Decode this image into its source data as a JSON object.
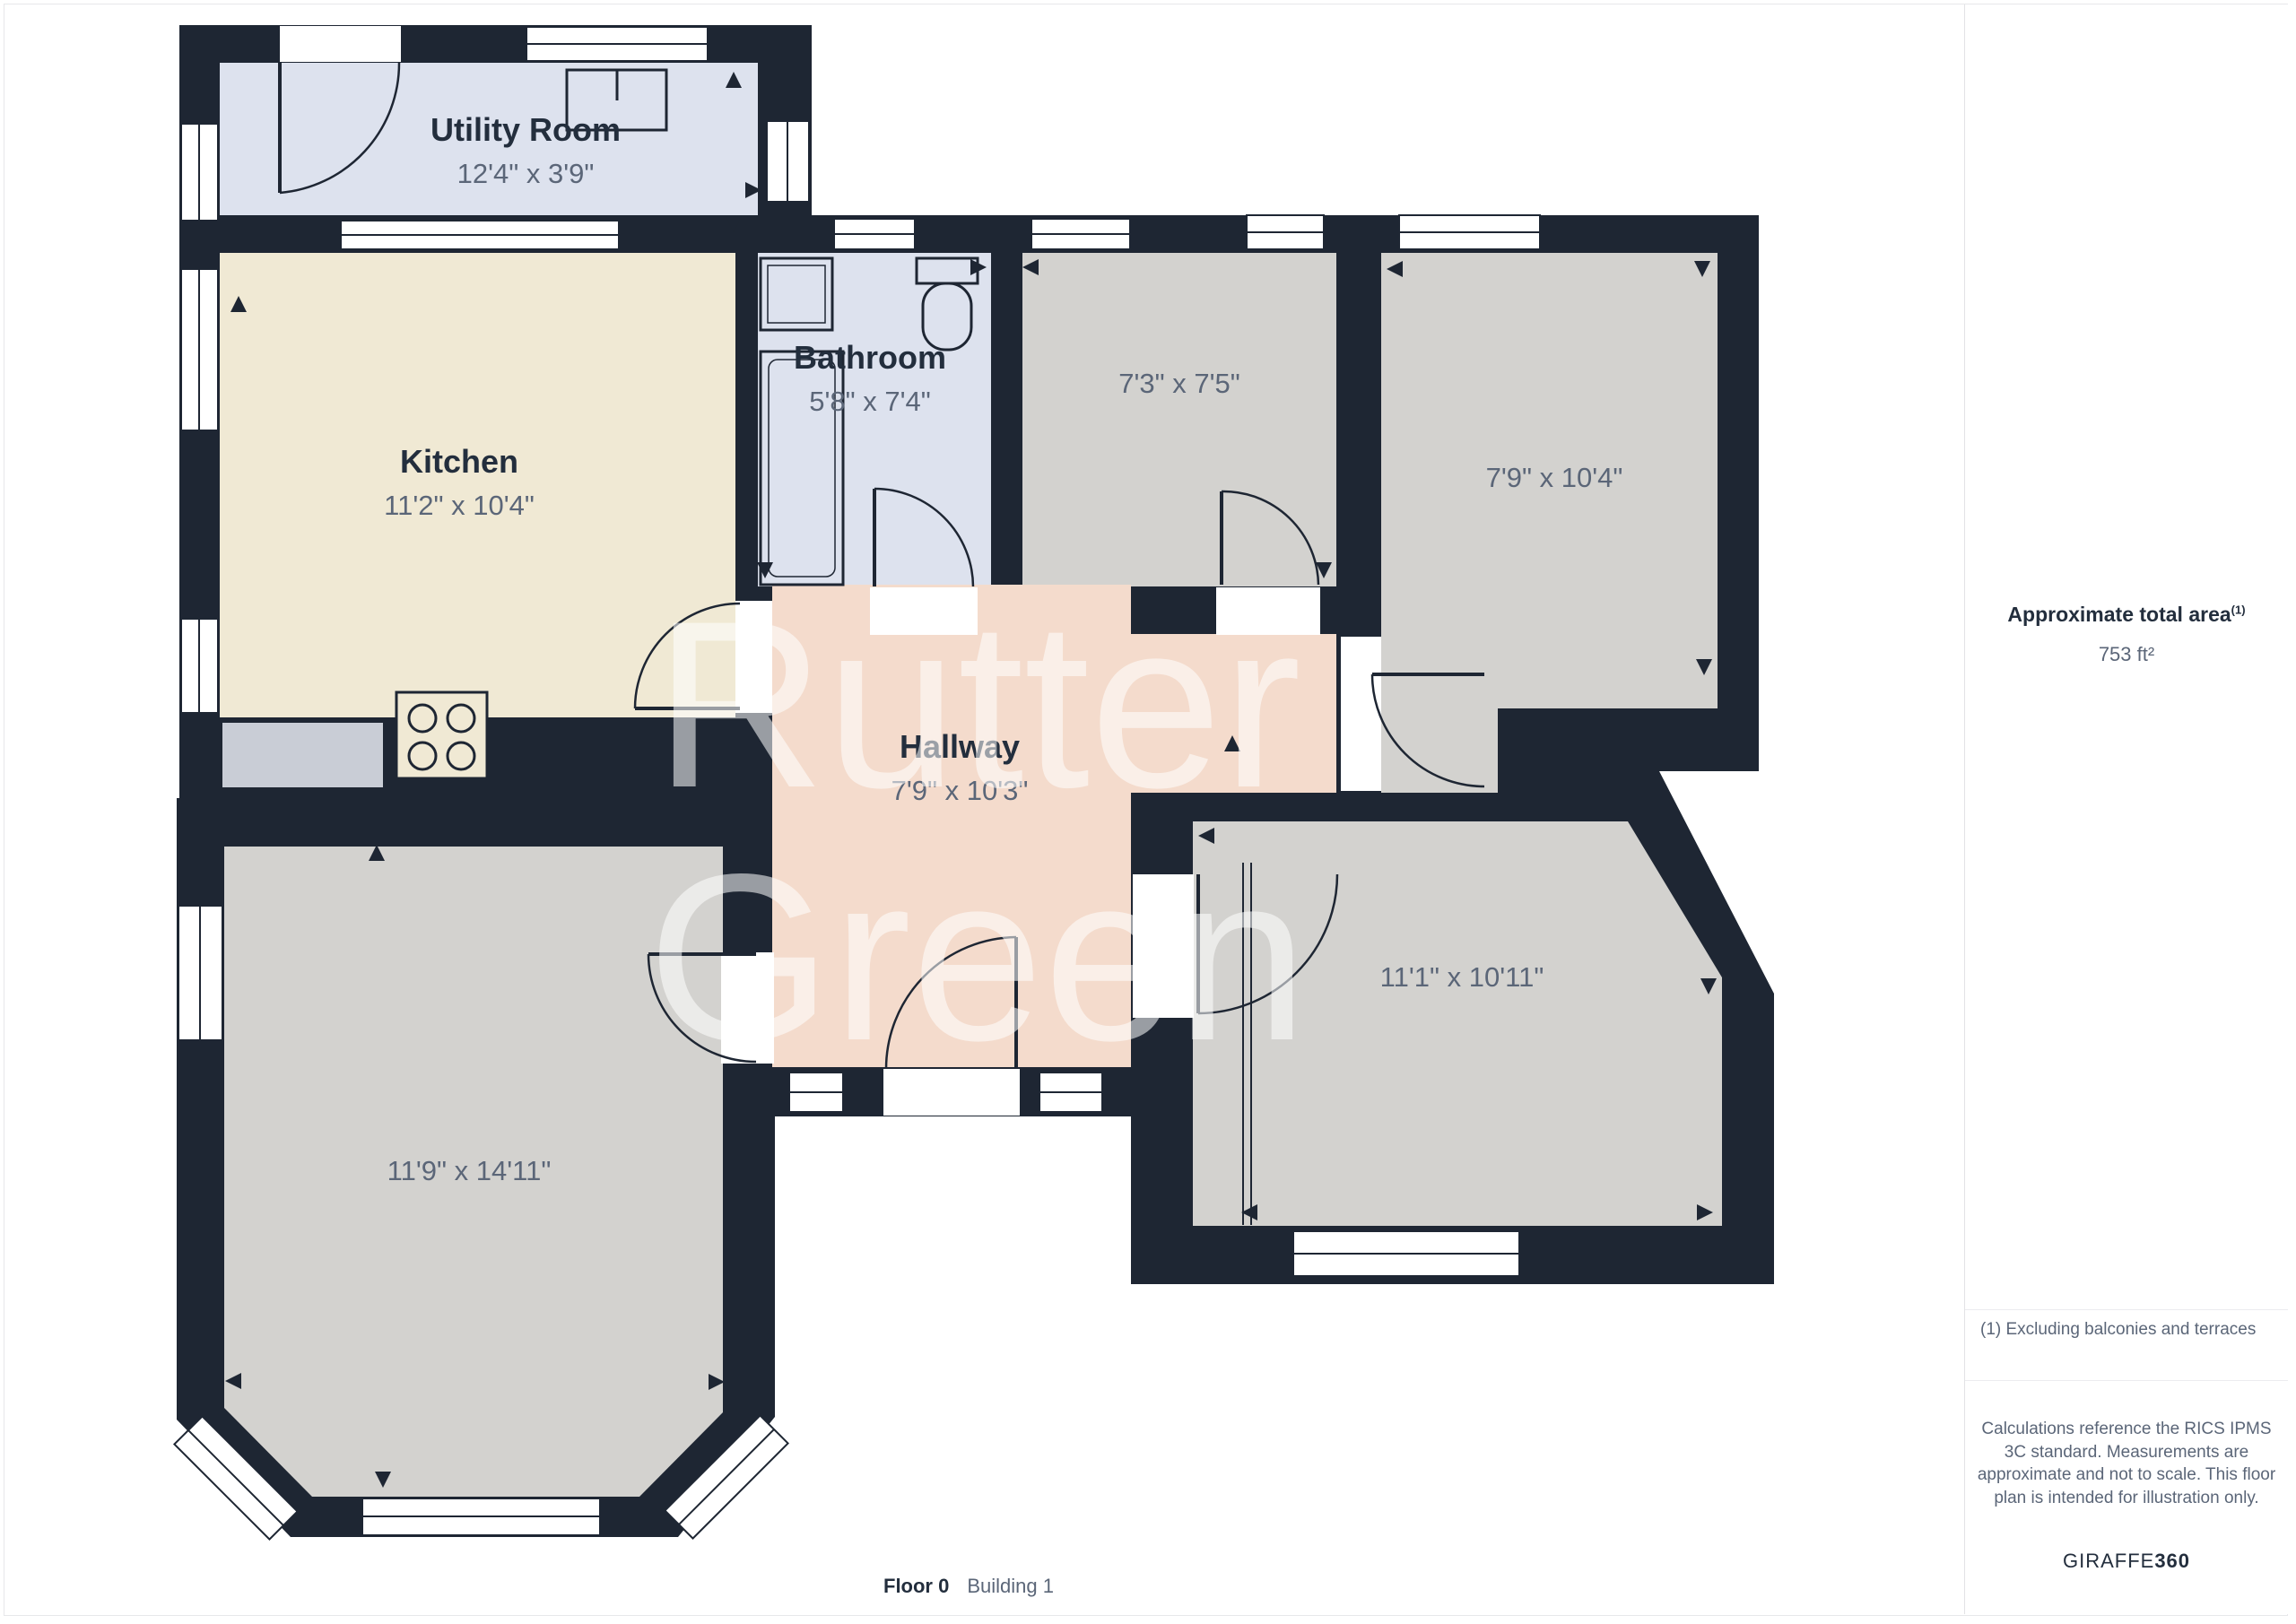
{
  "plan": {
    "rooms": [
      {
        "id": "utility",
        "name": "Utility Room",
        "dims": "12'4\" x 3'9\""
      },
      {
        "id": "kitchen",
        "name": "Kitchen",
        "dims": "11'2\" x 10'4\""
      },
      {
        "id": "bathroom",
        "name": "Bathroom",
        "dims": "5'8\" x 7'4\""
      },
      {
        "id": "room-73",
        "dims": "7'3\" x 7'5\""
      },
      {
        "id": "room-79",
        "dims": "7'9\" x 10'4\""
      },
      {
        "id": "hallway",
        "name": "Hallway",
        "dims": "7'9\" x 10'3\""
      },
      {
        "id": "room-111",
        "dims": "11'1\" x 10'11\""
      },
      {
        "id": "room-119",
        "dims": "11'9\" x 14'11\""
      }
    ],
    "watermark": {
      "line1": "Rutter",
      "line2": "Green"
    },
    "colors": {
      "wall": "#1e2633",
      "room_gray": "#d3d2cf",
      "kitchen": "#f0e9d4",
      "hallway": "#f4dbcc",
      "wet_room": "#dde2ee",
      "counter": "#c9cdd6",
      "label_dark": "#232e3d",
      "label_muted": "#5b6678"
    }
  },
  "sidebar": {
    "total_area_label": "Approximate total area",
    "total_area_footnote_marker": "(1)",
    "total_area_value": "753 ft²",
    "footnote": "(1) Excluding balconies and terraces",
    "disclaimer": "Calculations reference the RICS IPMS 3C standard. Measurements are approximate and not to scale. This floor plan is intended for illustration only.",
    "brand_name": "GIRAFFE",
    "brand_suffix": "360"
  },
  "footer": {
    "floor_label": "Floor 0",
    "building_label": "Building 1"
  }
}
